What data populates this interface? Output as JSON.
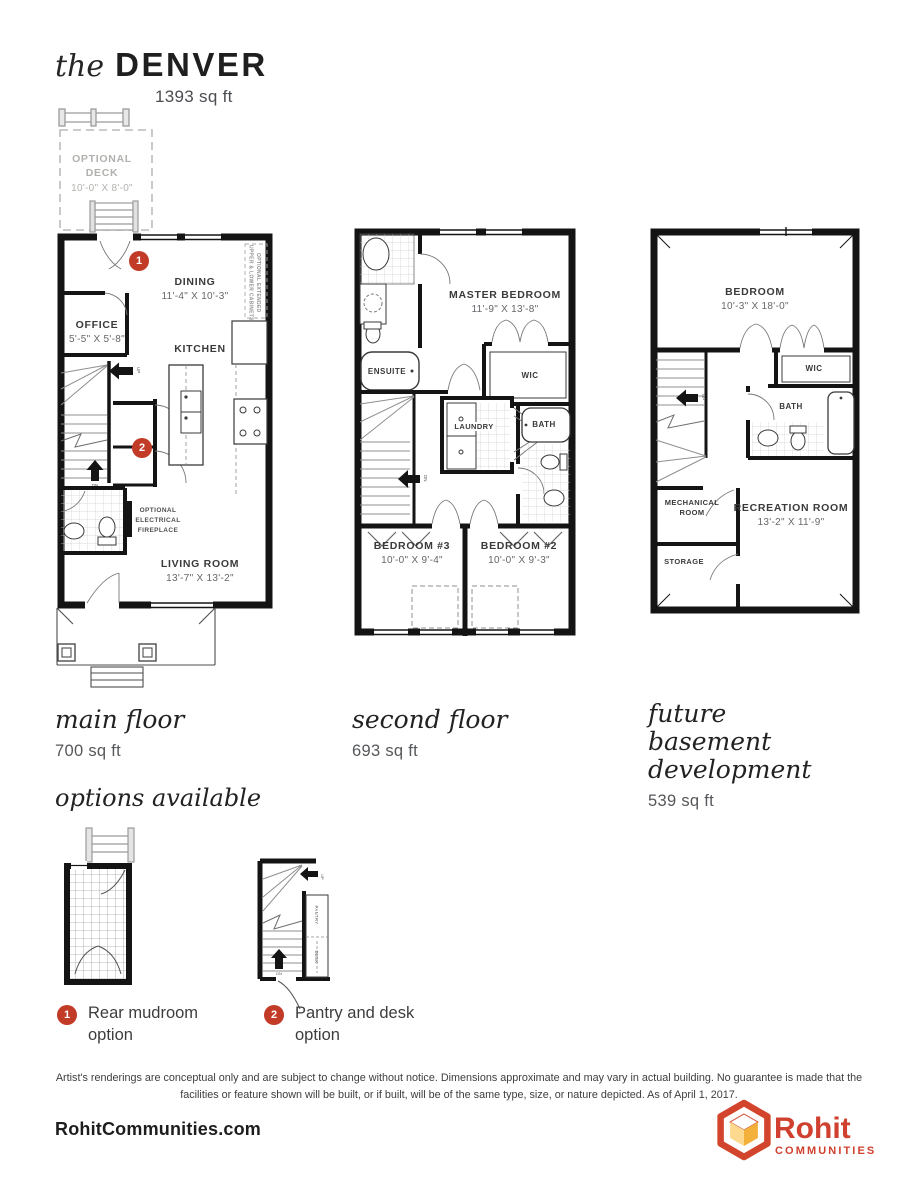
{
  "title": {
    "prefix": "the",
    "name": "DENVER",
    "sqft": "1393 sq ft"
  },
  "floors": {
    "main": {
      "caption": "main floor",
      "sqft": "700 sq ft",
      "rooms": {
        "deck": {
          "name": "OPTIONAL DECK",
          "dims": "10'-0\" X 8'-0\""
        },
        "dining": {
          "name": "DINING",
          "dims": "11'-4\" X 10'-3\""
        },
        "office": {
          "name": "OFFICE",
          "dims": "5'-5\" X 5'-8\""
        },
        "kitchen": {
          "name": "KITCHEN"
        },
        "living": {
          "name": "LIVING ROOM",
          "dims": "13'-7\" X 13'-2\""
        }
      },
      "notes": {
        "fireplace": "OPTIONAL ELECTRICAL FIREPLACE",
        "cabinets": "OPTIONAL EXTENDED UPPER & LOWER CABINETS"
      },
      "markers": {
        "m1": "1",
        "m2": "2"
      }
    },
    "second": {
      "caption": "second floor",
      "sqft": "693 sq ft",
      "rooms": {
        "master": {
          "name": "MASTER BEDROOM",
          "dims": "11'-9\" X 13'-8\""
        },
        "ensuite": {
          "name": "ENSUITE"
        },
        "wic": {
          "name": "WIC"
        },
        "laundry": {
          "name": "LAUNDRY"
        },
        "bath": {
          "name": "BATH"
        },
        "bed3": {
          "name": "BEDROOM #3",
          "dims": "10'-0\" X 9'-4\""
        },
        "bed2": {
          "name": "BEDROOM #2",
          "dims": "10'-0\" X 9'-3\""
        }
      }
    },
    "basement": {
      "caption": "future basement development",
      "sqft": "539 sq ft",
      "rooms": {
        "bedroom": {
          "name": "BEDROOM",
          "dims": "10'-3\" X 18'-0\""
        },
        "wic": {
          "name": "WIC"
        },
        "bath": {
          "name": "BATH"
        },
        "mech": {
          "name": "MECHANICAL ROOM"
        },
        "rec": {
          "name": "RECREATION ROOM",
          "dims": "13'-2\" X 11'-9\""
        },
        "storage": {
          "name": "STORAGE"
        }
      }
    }
  },
  "options": {
    "heading": "options available",
    "items": [
      {
        "badge": "1",
        "label": "Rear mudroom option"
      },
      {
        "badge": "2",
        "label": "Pantry and desk option"
      }
    ],
    "pantry": "PANTRY",
    "desk": "DESK"
  },
  "stairs": {
    "up": "UP",
    "dn": "DN"
  },
  "disclaimer": {
    "text": "Artist's renderings are conceptual only and are subject to change without notice. Dimensions approximate and may vary in actual building. No guarantee is made that the facilities or feature shown will be built, or if built, will be of the same type, size, or nature depicted. As of April 1, 2017."
  },
  "footer": {
    "website": "RohitCommunities.com",
    "brand": "Rohit",
    "brand_sub": "COMMUNITIES"
  },
  "colors": {
    "marker_red": "#c23b27",
    "logo_red": "#d0402e",
    "logo_yellow_left": "#fcd98f",
    "logo_yellow_right": "#f3b13c",
    "wall_black": "#141414",
    "muted_gray": "#b3b1ae"
  }
}
